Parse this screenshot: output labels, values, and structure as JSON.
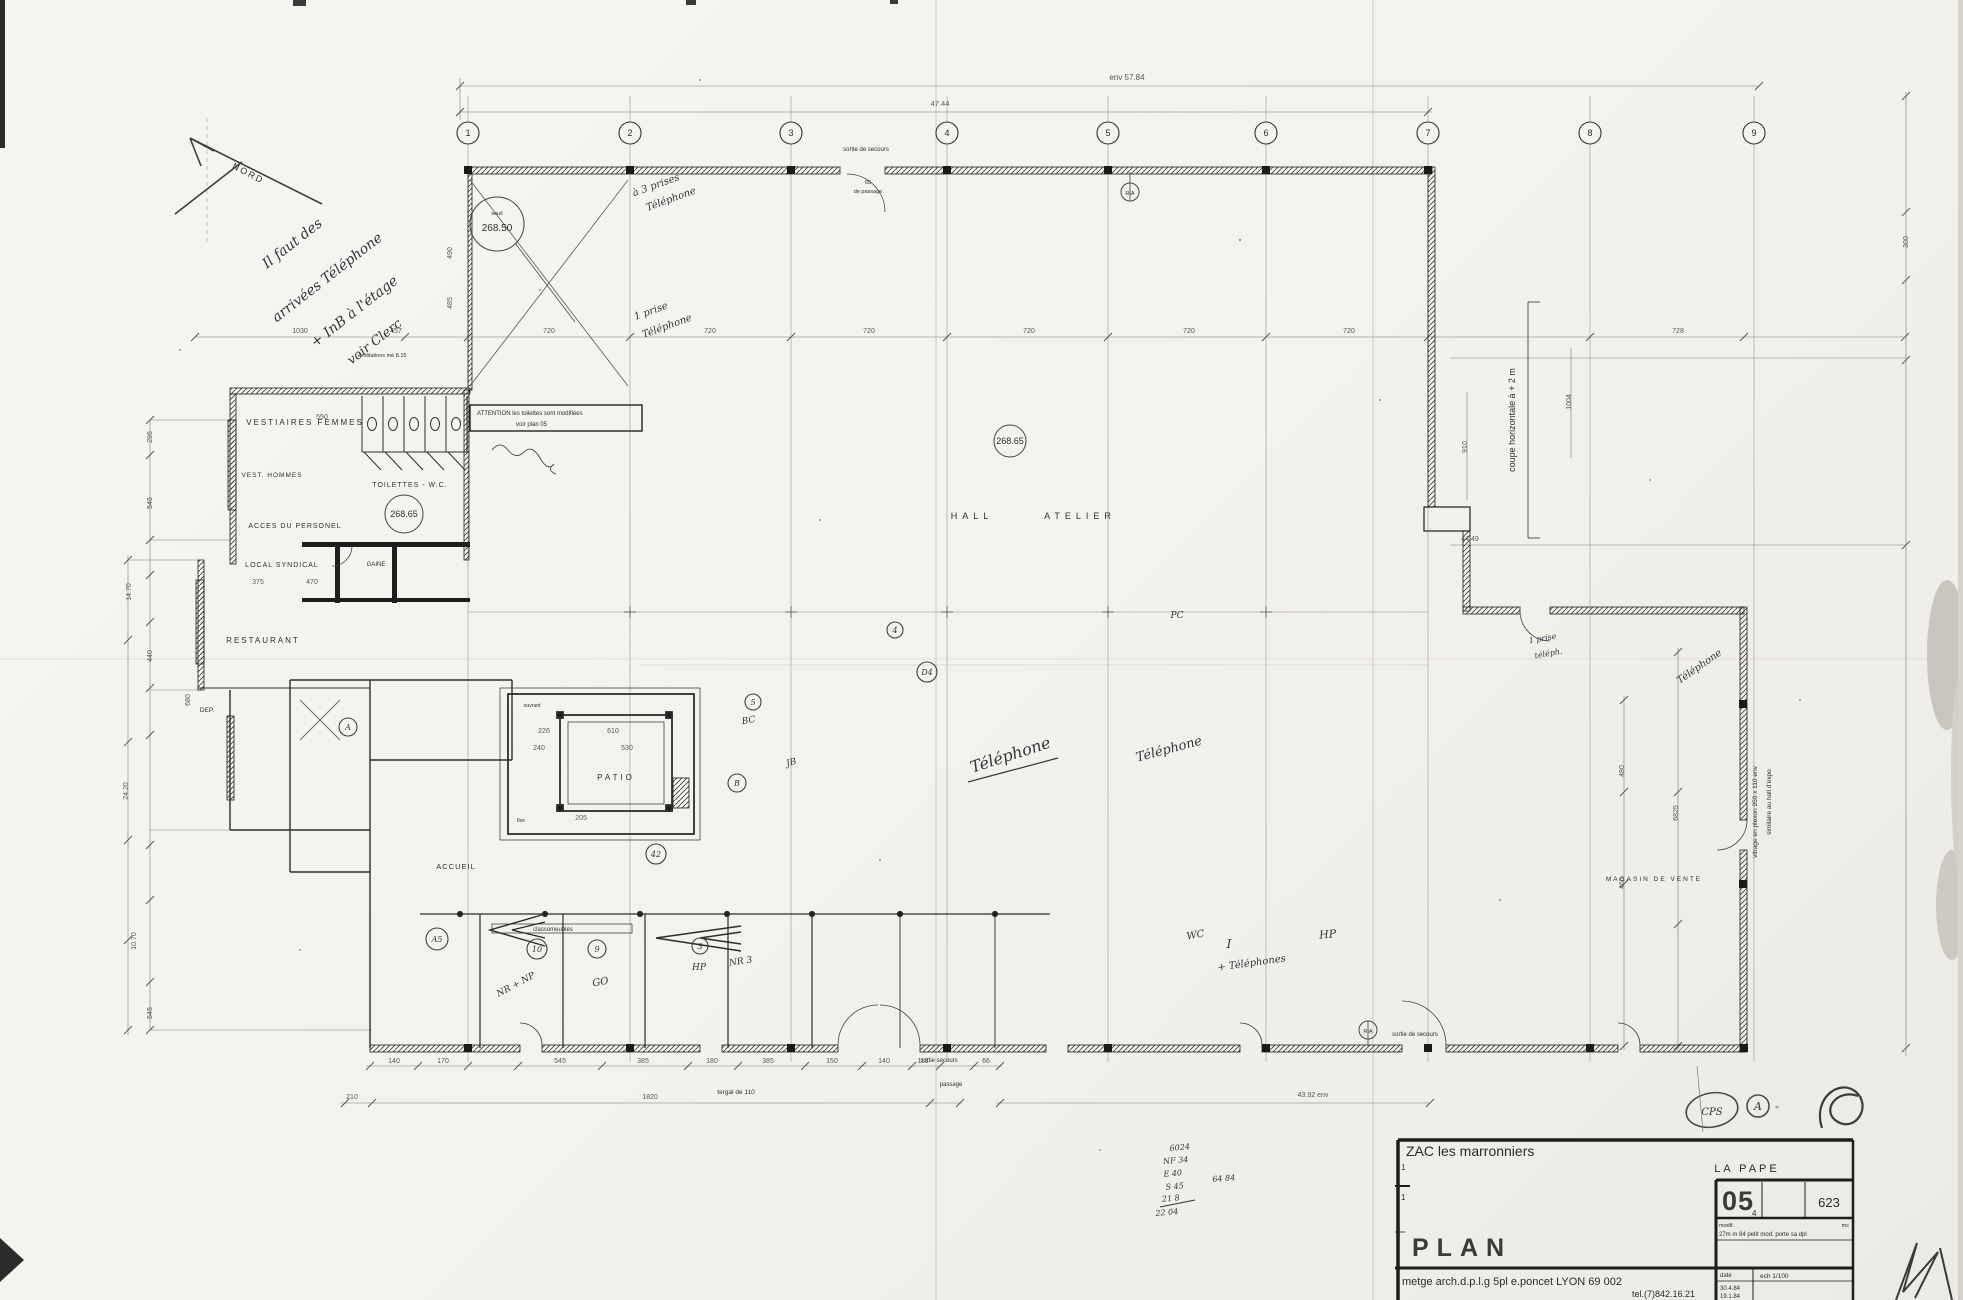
{
  "sheet_title": "PLAN",
  "compass": {
    "label": "NORD"
  },
  "grid": {
    "y": 133,
    "bubbles": [
      {
        "n": "1",
        "x": 468
      },
      {
        "n": "2",
        "x": 630
      },
      {
        "n": "3",
        "x": 791
      },
      {
        "n": "4",
        "x": 947
      },
      {
        "n": "5",
        "x": 1108
      },
      {
        "n": "6",
        "x": 1266
      },
      {
        "n": "7",
        "x": 1428
      },
      {
        "n": "8",
        "x": 1590
      },
      {
        "n": "9",
        "x": 1754
      }
    ]
  },
  "attention": {
    "l1": "ATTENTION   les toilettes sont modifiées",
    "l2": "voir   plan 05"
  },
  "circled": [
    {
      "t": "268.50",
      "x": 497,
      "y": 224,
      "r": 27,
      "fs": 10,
      "sub": "seuil"
    },
    {
      "t": "268.65",
      "x": 404,
      "y": 514,
      "r": 19,
      "fs": 9
    },
    {
      "t": "268.65",
      "x": 1010,
      "y": 441,
      "r": 16,
      "fs": 9
    },
    {
      "t": "RIA",
      "x": 1130,
      "y": 192,
      "r": 9,
      "fs": 5.5
    },
    {
      "t": "RIA",
      "x": 1368,
      "y": 1030,
      "r": 9,
      "fs": 5.5
    },
    {
      "t": "A",
      "x": 348,
      "y": 727,
      "r": 9,
      "fs": 8,
      "hand": 1
    },
    {
      "t": "B",
      "x": 737,
      "y": 783,
      "r": 9,
      "fs": 8,
      "hand": 1
    },
    {
      "t": "4",
      "x": 895,
      "y": 630,
      "r": 8,
      "fs": 8,
      "hand": 1
    },
    {
      "t": "5",
      "x": 753,
      "y": 702,
      "r": 8,
      "fs": 8,
      "hand": 1
    },
    {
      "t": "D4",
      "x": 927,
      "y": 672,
      "r": 10,
      "fs": 8,
      "hand": 1
    },
    {
      "t": "A5",
      "x": 437,
      "y": 939,
      "r": 11,
      "fs": 8,
      "hand": 1
    },
    {
      "t": "10",
      "x": 537,
      "y": 949,
      "r": 10,
      "fs": 8,
      "hand": 1
    },
    {
      "t": "9",
      "x": 597,
      "y": 949,
      "r": 9,
      "fs": 8,
      "hand": 1
    },
    {
      "t": "3",
      "x": 700,
      "y": 946,
      "r": 8,
      "fs": 8,
      "hand": 1
    },
    {
      "t": "42",
      "x": 656,
      "y": 854,
      "r": 10,
      "fs": 8,
      "hand": 1
    }
  ],
  "tech_labels": [
    {
      "t": "VESTIAIRES  FEMMES",
      "x": 305,
      "y": 425,
      "fs": 8,
      "ls": 2
    },
    {
      "t": "VEST. HOMMES",
      "x": 272,
      "y": 477,
      "fs": 6.5,
      "ls": 1
    },
    {
      "t": "TOILETTES - W.C.",
      "x": 410,
      "y": 487,
      "fs": 7,
      "ls": 1
    },
    {
      "t": "ACCES DU PERSONEL",
      "x": 295,
      "y": 528,
      "fs": 7,
      "ls": 1
    },
    {
      "t": "LOCAL SYNDICAL",
      "x": 282,
      "y": 567,
      "fs": 7,
      "ls": 1
    },
    {
      "t": "GAINE",
      "x": 376,
      "y": 566,
      "fs": 6
    },
    {
      "t": "RESTAURANT",
      "x": 263,
      "y": 643,
      "fs": 8,
      "ls": 2
    },
    {
      "t": "DEP.",
      "x": 207,
      "y": 712,
      "fs": 6.5
    },
    {
      "t": "PATIO",
      "x": 616,
      "y": 780,
      "fs": 8,
      "ls": 3
    },
    {
      "t": "ACCUEIL",
      "x": 456,
      "y": 869,
      "fs": 7.5,
      "ls": 1
    },
    {
      "t": "classomeubles",
      "x": 553,
      "y": 931,
      "fs": 6
    },
    {
      "t": "HALL",
      "x": 972,
      "y": 519,
      "fs": 9,
      "ls": 5
    },
    {
      "t": "ATELIER",
      "x": 1080,
      "y": 519,
      "fs": 9,
      "ls": 5
    },
    {
      "t": "MAGASIN DE VENTE",
      "x": 1654,
      "y": 881,
      "fs": 6.5,
      "ls": 2
    },
    {
      "t": "coupe  horizontale  à  + 2 m",
      "x": 1515,
      "y": 420,
      "fs": 9,
      "r": -90
    },
    {
      "t": "vitrage en plexon  950 x 110 env",
      "x": 1757,
      "y": 812,
      "fs": 6.5,
      "r": -90
    },
    {
      "t": "similaire au hall  d'expo",
      "x": 1771,
      "y": 802,
      "fs": 6.5,
      "r": -90
    },
    {
      "t": "ventilations mé 8.15",
      "x": 382,
      "y": 357,
      "fs": 5.5
    },
    {
      "t": "sortie de secours",
      "x": 866,
      "y": 151,
      "fs": 6
    },
    {
      "t": "65",
      "x": 868,
      "y": 184,
      "fs": 5.5
    },
    {
      "t": "de passage",
      "x": 868,
      "y": 193,
      "fs": 5.5
    },
    {
      "t": "sortie de secours",
      "x": 1415,
      "y": 1036,
      "fs": 6
    },
    {
      "t": "sortie secours",
      "x": 939,
      "y": 1062,
      "fs": 6
    },
    {
      "t": "passage",
      "x": 951,
      "y": 1086,
      "fs": 6
    },
    {
      "t": "tergal de 110",
      "x": 736,
      "y": 1094,
      "fs": 6.5
    },
    {
      "t": "ouvrant",
      "x": 532,
      "y": 707,
      "fs": 5
    },
    {
      "t": "fixe",
      "x": 521,
      "y": 822,
      "fs": 5
    }
  ],
  "dim_labels": [
    {
      "t": "env  57.84",
      "x": 1127,
      "y": 80,
      "fs": 8
    },
    {
      "t": "47.44",
      "x": 940,
      "y": 106,
      "fs": 7.5
    },
    {
      "t": "1030",
      "x": 300,
      "y": 333
    },
    {
      "t": "457",
      "x": 396,
      "y": 333
    },
    {
      "t": "720",
      "x": 549,
      "y": 333
    },
    {
      "t": "720",
      "x": 710,
      "y": 333
    },
    {
      "t": "720",
      "x": 869,
      "y": 333
    },
    {
      "t": "720",
      "x": 1029,
      "y": 333
    },
    {
      "t": "720",
      "x": 1189,
      "y": 333
    },
    {
      "t": "720",
      "x": 1349,
      "y": 333
    },
    {
      "t": "728",
      "x": 1678,
      "y": 333
    },
    {
      "t": "490",
      "x": 452,
      "y": 253,
      "r": -90
    },
    {
      "t": "485",
      "x": 452,
      "y": 303,
      "r": -90
    },
    {
      "t": "295",
      "x": 152,
      "y": 437,
      "r": -90
    },
    {
      "t": "545",
      "x": 152,
      "y": 503,
      "r": -90
    },
    {
      "t": "14.70",
      "x": 131,
      "y": 592,
      "r": -90
    },
    {
      "t": "440",
      "x": 152,
      "y": 656,
      "r": -90
    },
    {
      "t": "680",
      "x": 190,
      "y": 700,
      "r": -90
    },
    {
      "t": "24.20",
      "x": 128,
      "y": 791,
      "r": -90
    },
    {
      "t": "10.70",
      "x": 136,
      "y": 941,
      "r": -90
    },
    {
      "t": "545",
      "x": 152,
      "y": 1013,
      "r": -90
    },
    {
      "t": "550",
      "x": 322,
      "y": 419
    },
    {
      "t": "375",
      "x": 258,
      "y": 584
    },
    {
      "t": "470",
      "x": 312,
      "y": 584
    },
    {
      "t": "226",
      "x": 544,
      "y": 733
    },
    {
      "t": "610",
      "x": 613,
      "y": 733
    },
    {
      "t": "240",
      "x": 539,
      "y": 750
    },
    {
      "t": "530",
      "x": 627,
      "y": 750
    },
    {
      "t": "205",
      "x": 581,
      "y": 820
    },
    {
      "t": "140",
      "x": 394,
      "y": 1063
    },
    {
      "t": "170",
      "x": 443,
      "y": 1063
    },
    {
      "t": "545",
      "x": 560,
      "y": 1063
    },
    {
      "t": "385",
      "x": 643,
      "y": 1063
    },
    {
      "t": "180",
      "x": 712,
      "y": 1063
    },
    {
      "t": "385",
      "x": 768,
      "y": 1063
    },
    {
      "t": "150",
      "x": 832,
      "y": 1063
    },
    {
      "t": "140",
      "x": 884,
      "y": 1063
    },
    {
      "t": "118",
      "x": 923,
      "y": 1063
    },
    {
      "t": "66",
      "x": 986,
      "y": 1063
    },
    {
      "t": "210",
      "x": 352,
      "y": 1099
    },
    {
      "t": "1820",
      "x": 650,
      "y": 1099
    },
    {
      "t": "43.92  env",
      "x": 1313,
      "y": 1097
    },
    {
      "t": "1004",
      "x": 1571,
      "y": 402,
      "r": -90
    },
    {
      "t": "910",
      "x": 1467,
      "y": 447,
      "r": -90
    },
    {
      "t": "44.49",
      "x": 1470,
      "y": 541
    },
    {
      "t": "6825",
      "x": 1678,
      "y": 813,
      "r": -90
    },
    {
      "t": "480",
      "x": 1624,
      "y": 771,
      "r": -90
    },
    {
      "t": "460",
      "x": 1624,
      "y": 883,
      "r": -90
    },
    {
      "t": "300",
      "x": 1908,
      "y": 242,
      "r": -90
    }
  ],
  "hand_labels": [
    {
      "t": "Il faut des",
      "x": 295,
      "y": 247,
      "r": -38,
      "fs": 14
    },
    {
      "t": "arrivées Téléphone",
      "x": 330,
      "y": 281,
      "r": -38,
      "fs": 14
    },
    {
      "t": "+ InB à l'étage",
      "x": 357,
      "y": 315,
      "r": -38,
      "fs": 14
    },
    {
      "t": "voir Clerc",
      "x": 377,
      "y": 345,
      "r": -38,
      "fs": 13
    },
    {
      "t": "à 3 prises",
      "x": 657,
      "y": 188,
      "r": -20,
      "fs": 10
    },
    {
      "t": "Téléphone",
      "x": 672,
      "y": 202,
      "r": -20,
      "fs": 10
    },
    {
      "t": "1 prise",
      "x": 652,
      "y": 314,
      "r": -20,
      "fs": 10
    },
    {
      "t": "Téléphone",
      "x": 668,
      "y": 329,
      "r": -20,
      "fs": 10
    },
    {
      "t": "Téléphone",
      "x": 1012,
      "y": 760,
      "r": -18,
      "fs": 16
    },
    {
      "t": "Téléphone",
      "x": 1170,
      "y": 753,
      "r": -15,
      "fs": 13
    },
    {
      "t": "I",
      "x": 1229,
      "y": 948,
      "fs": 12
    },
    {
      "t": "+ Téléphones",
      "x": 1252,
      "y": 966,
      "r": -8,
      "fs": 10
    },
    {
      "t": "WC",
      "x": 1196,
      "y": 938,
      "r": -10,
      "fs": 10
    },
    {
      "t": "HP",
      "x": 1328,
      "y": 938,
      "r": -5,
      "fs": 11
    },
    {
      "t": "HP",
      "x": 699,
      "y": 970,
      "fs": 9
    },
    {
      "t": "NR + NP",
      "x": 517,
      "y": 987,
      "r": -28,
      "fs": 9
    },
    {
      "t": "GO",
      "x": 601,
      "y": 985,
      "r": -10,
      "fs": 10
    },
    {
      "t": "NR 3",
      "x": 741,
      "y": 964,
      "r": -8,
      "fs": 9
    },
    {
      "t": "PC",
      "x": 1177,
      "y": 618,
      "fs": 9
    },
    {
      "t": "BC",
      "x": 749,
      "y": 723,
      "r": -10,
      "fs": 9
    },
    {
      "t": "JB",
      "x": 792,
      "y": 765,
      "r": -15,
      "fs": 9
    },
    {
      "t": "1 prise",
      "x": 1543,
      "y": 641,
      "r": -10,
      "fs": 8
    },
    {
      "t": "téléph.",
      "x": 1549,
      "y": 656,
      "r": -10,
      "fs": 8
    },
    {
      "t": "Téléphone",
      "x": 1701,
      "y": 669,
      "r": -35,
      "fs": 10
    },
    {
      "t": "6024",
      "x": 1180,
      "y": 1150,
      "r": -5,
      "fs": 8
    },
    {
      "t": "NF 34",
      "x": 1176,
      "y": 1163,
      "r": -5,
      "fs": 8
    },
    {
      "t": "E 40",
      "x": 1173,
      "y": 1176,
      "r": -5,
      "fs": 8
    },
    {
      "t": "S 45",
      "x": 1175,
      "y": 1189,
      "r": -5,
      "fs": 8
    },
    {
      "t": "21 8",
      "x": 1171,
      "y": 1201,
      "r": -5,
      "fs": 8
    },
    {
      "t": "22 04",
      "x": 1167,
      "y": 1215,
      "r": -5,
      "fs": 8
    },
    {
      "t": "64 84",
      "x": 1224,
      "y": 1181,
      "r": -5,
      "fs": 8
    }
  ],
  "title_block": {
    "project": "ZAC  les marronniers",
    "margin_mark_1": "1",
    "margin_mark_2": "1",
    "place": "LA  PAPE",
    "sheet_no": "05",
    "sheet_sub": "4",
    "ref": "623",
    "modif_label": "modif.",
    "modif_text": "27m m 84   petit mod. porte   sa dpl",
    "modif_right": "mc",
    "doc_type": "PLAN",
    "architect": "metge arch.d.p.l.g   5pl e.poncet LYON   69 002",
    "phone": "tel.(7)842.16.21",
    "date_label": "date",
    "scale_label": "ech   1/100",
    "date1": "30.4.84",
    "date2": "19.1.84",
    "stamp_cps": "CPS",
    "stamp_a": "A",
    "stamp_dash": "-"
  }
}
